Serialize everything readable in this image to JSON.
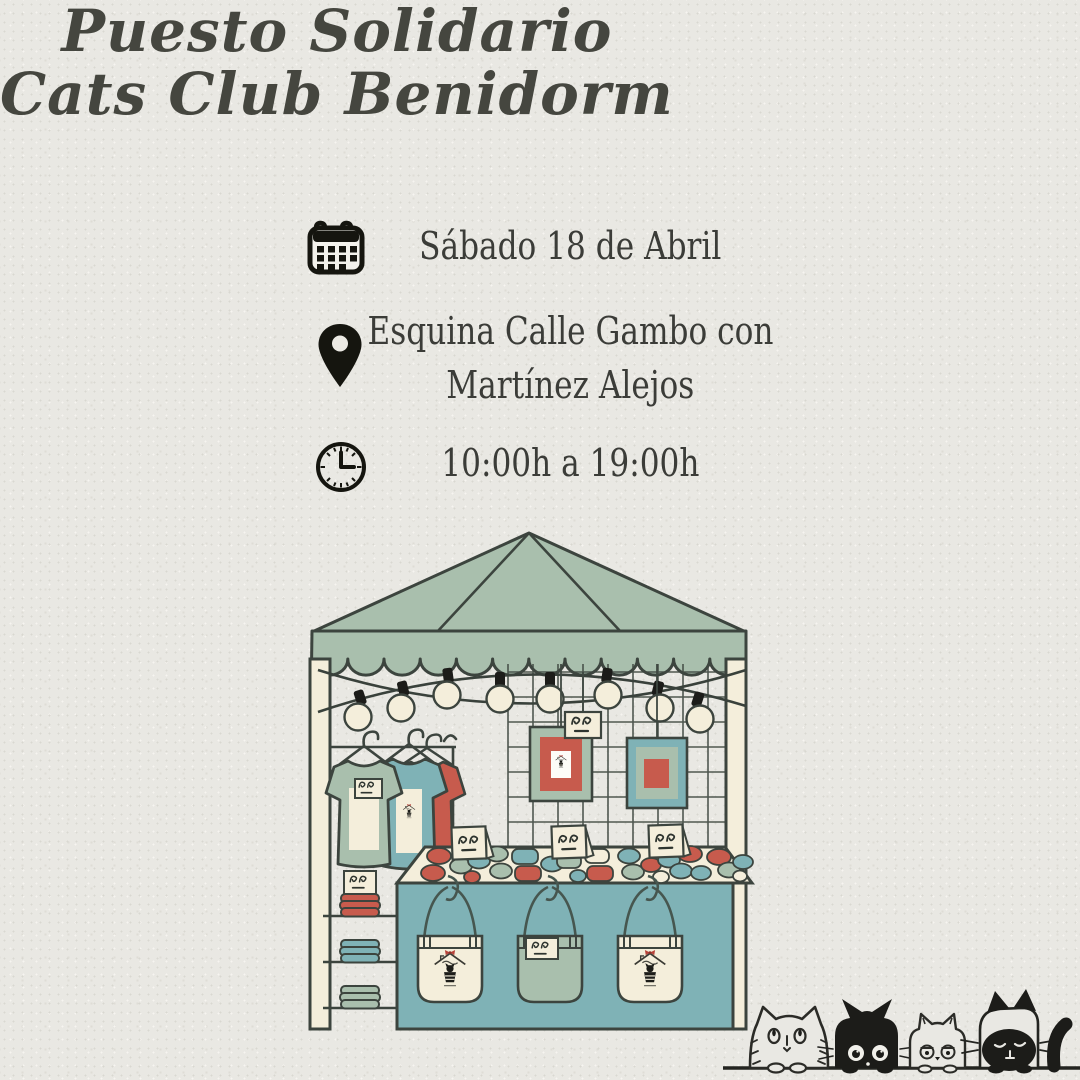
{
  "poster": {
    "title": {
      "line1": "Puesto Solidario",
      "line2": "Cats Club Benidorm"
    },
    "details": [
      {
        "icon": "calendar-icon",
        "lines": [
          "Sábado 18 de Abril"
        ]
      },
      {
        "icon": "location-pin-icon",
        "lines": [
          "Esquina Calle Gambo con",
          "Martínez Alejos"
        ]
      },
      {
        "icon": "clock-icon",
        "lines": [
          "10:00h a 19:00h"
        ]
      }
    ],
    "illustration": {
      "subject": "market-stall-tent",
      "elements": [
        "string-lights",
        "hanging-tshirts",
        "picture-frames",
        "pin-badges-table",
        "tote-bags",
        "folded-textiles-shelf",
        "price-cards"
      ],
      "cats": [
        "white-fluffy-cat",
        "black-cat",
        "small-white-cat",
        "siamese-cat"
      ]
    },
    "colors": {
      "paper": "#e9e8e3",
      "ink": "#1c1c19",
      "outline": "#3c443e",
      "title_ink": "#45463f",
      "text_ink": "#3b3c38",
      "sage": "#a9bfad",
      "teal": "#7fb2b6",
      "red": "#c75b4d",
      "cream": "#f4eedb"
    }
  }
}
